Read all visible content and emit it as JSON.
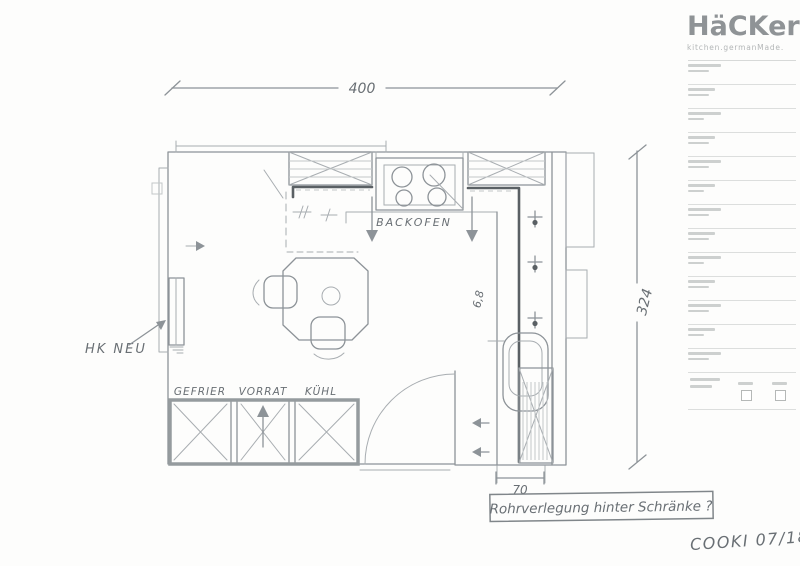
{
  "brand": {
    "logo": "HäCKer",
    "tagline": "kitchen.germanMade."
  },
  "colors": {
    "brand_gray": "#8f9396",
    "pencil_gray": "#8d9398",
    "pipe_line_dark": "#5a6064"
  },
  "plan": {
    "dim_width": "400",
    "dim_height": "324",
    "dim_pipe": "70",
    "oven": "BACKOFEN",
    "radiator": "HK NEU",
    "freezer": "GEFRIER",
    "pantry": "VORRAT",
    "fridge": "KÜHL",
    "measure": "6,8",
    "note": "Rohrverlegung hinter Schränke ?",
    "signature": "COOKI 07/18"
  }
}
